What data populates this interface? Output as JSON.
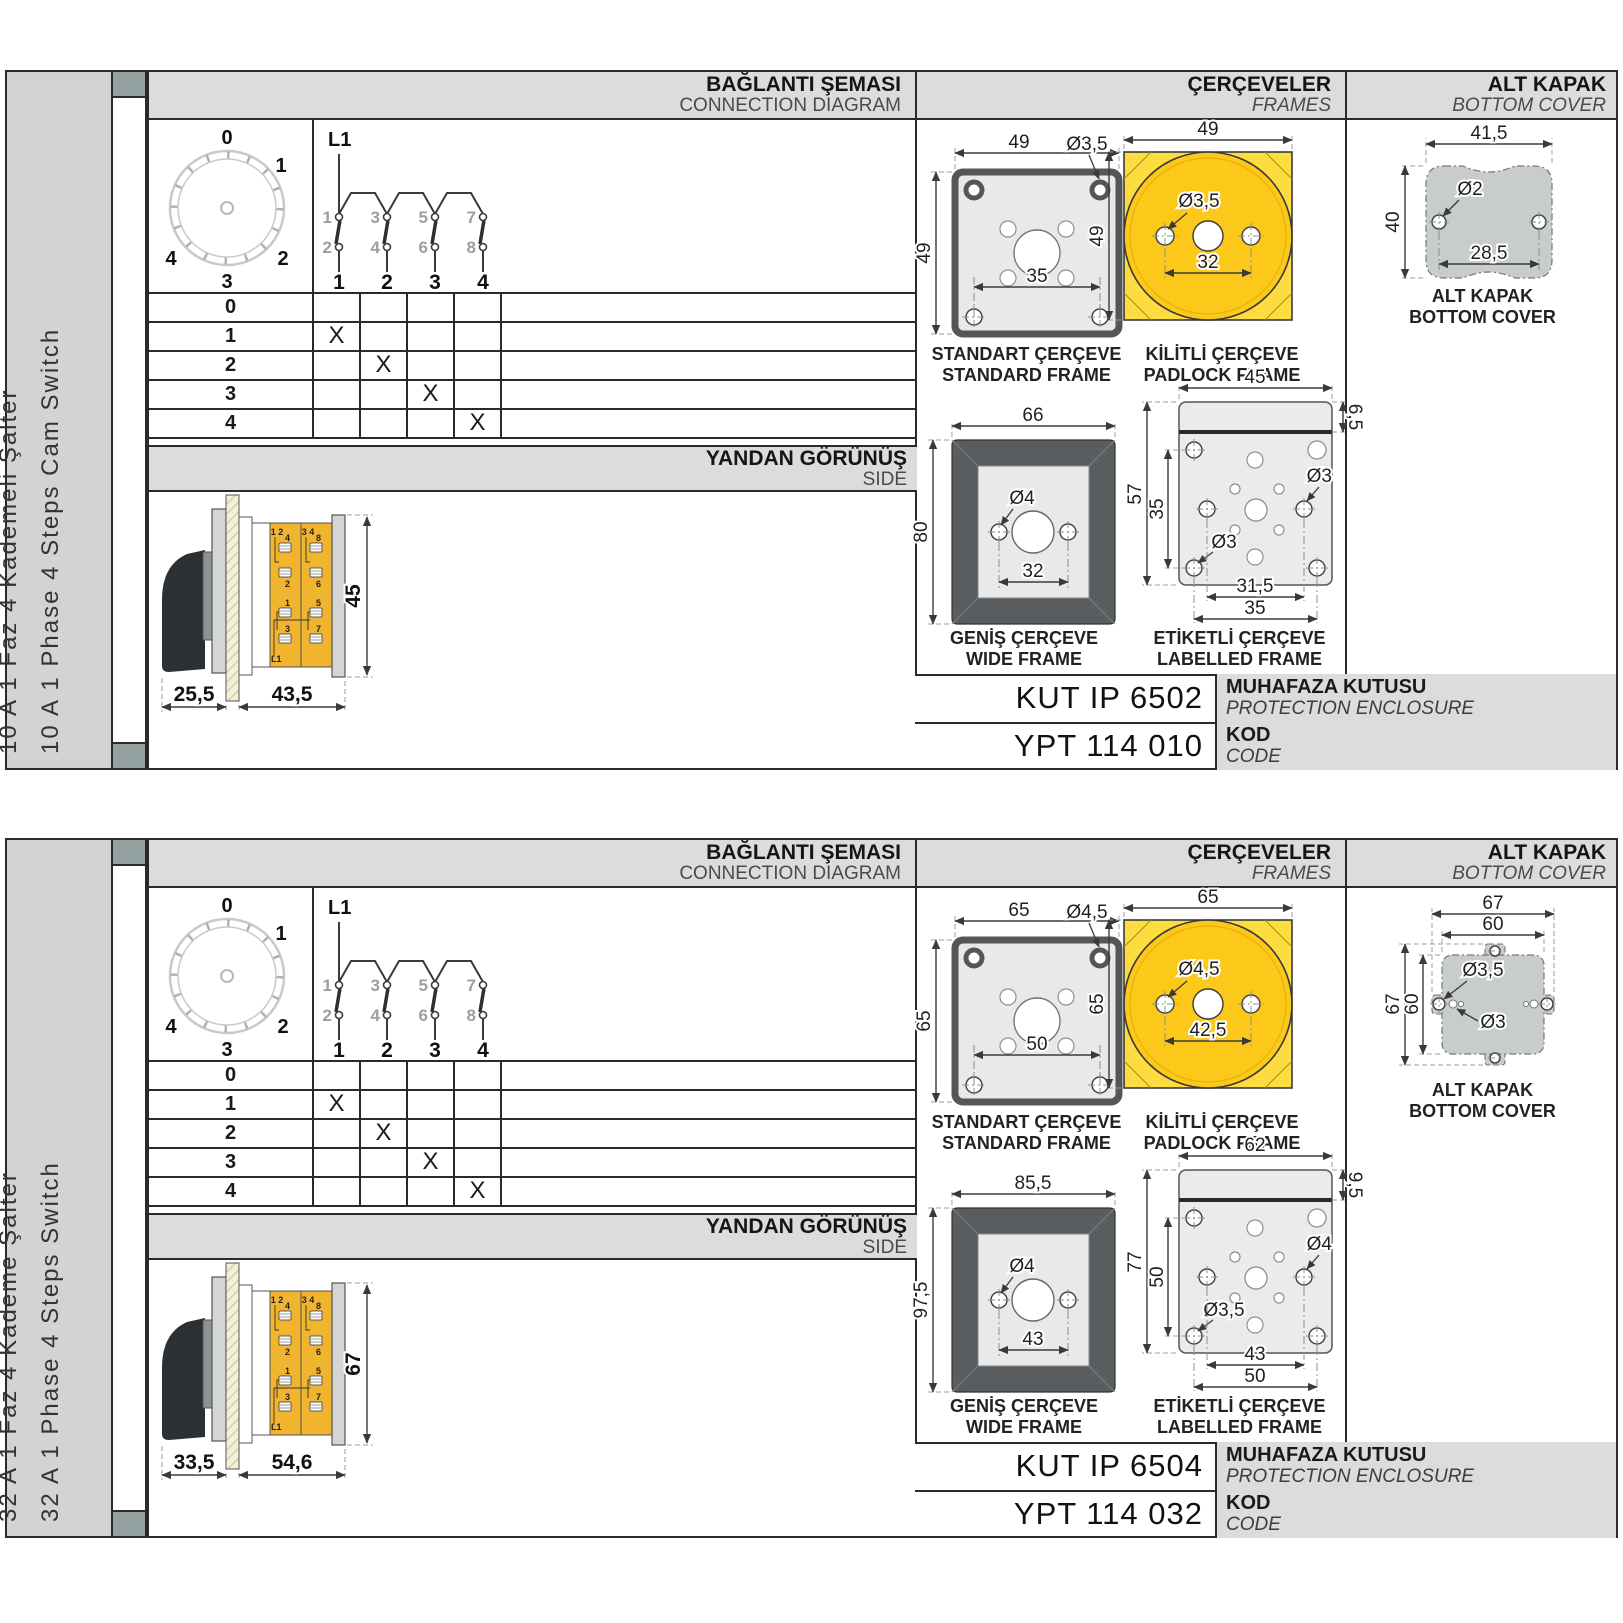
{
  "colors": {
    "accent_yellow": "#fcc91a",
    "terminal_orange": "#f0b42f",
    "band_gray": "#dcdcdc",
    "cover_gray": "#c9cccc",
    "frame_dark_gray": "#595d60"
  },
  "panels": [
    {
      "side_labels": [
        "10 A 1 Faz 4 Kademeli Şalter",
        "10 A 1 Phase 4 Steps Cam Switch"
      ],
      "headers": {
        "conn_tr": "BAĞLANTI ŞEMASI",
        "conn_en": "CONNECTION DIAGRAM",
        "frames_tr": "ÇERÇEVELER",
        "frames_en": "FRAMES",
        "cover_tr": "ALT KAPAK",
        "cover_en": "BOTTOM COVER",
        "side_tr": "YANDAN GÖRÜNÜŞ",
        "side_en": "SIDE"
      },
      "dial": [
        "0",
        "1",
        "2",
        "3",
        "4"
      ],
      "contact": {
        "feed": "L1",
        "upper": [
          "1",
          "3",
          "5",
          "7"
        ],
        "lower": [
          "2",
          "4",
          "6",
          "8"
        ],
        "poles": [
          "1",
          "2",
          "3",
          "4"
        ]
      },
      "table": {
        "rows": [
          {
            "label": "0",
            "cells": [
              "",
              "",
              "",
              ""
            ]
          },
          {
            "label": "1",
            "cells": [
              "X",
              "",
              "",
              ""
            ]
          },
          {
            "label": "2",
            "cells": [
              "",
              "X",
              "",
              ""
            ]
          },
          {
            "label": "3",
            "cells": [
              "",
              "",
              "X",
              ""
            ]
          },
          {
            "label": "4",
            "cells": [
              "",
              "",
              "",
              "X"
            ]
          }
        ]
      },
      "side_view": {
        "dim_front": "25,5",
        "dim_body": "43,5",
        "dim_height": "45",
        "t": {
          "c1top": "1 2",
          "c2top": "3 4",
          "a1": "4",
          "a2": "2",
          "a3": "1",
          "a4": "3",
          "b1": "8",
          "b2": "6",
          "b3": "5",
          "b4": "7",
          "feed": "L1"
        }
      },
      "frames": {
        "standard": {
          "cap1": "STANDART ÇERÇEVE",
          "cap2": "STANDARD FRAME",
          "w": "49",
          "h": "49",
          "hole": "Ø3,5",
          "inner": "35"
        },
        "padlock": {
          "cap1": "KİLİTLİ ÇERÇEVE",
          "cap2": "PADLOCK FRAME",
          "w": "49",
          "h": "49",
          "hole": "Ø3,5",
          "inner": "32"
        },
        "wide": {
          "cap1": "GENİŞ ÇERÇEVE",
          "cap2": "WIDE FRAME",
          "w": "66",
          "h": "80",
          "hole": "Ø4",
          "inner": "32"
        },
        "labelled": {
          "cap1": "ETİKETLİ ÇERÇEVE",
          "cap2": "LABELLED FRAME",
          "w": "45",
          "h_outer": "57",
          "h_inner": "35",
          "strip": "6,5",
          "hole_right": "Ø3",
          "hole_left": "Ø3",
          "b1": "31,5",
          "b2": "35"
        }
      },
      "cover": {
        "cap1": "ALT KAPAK",
        "cap2": "BOTTOM COVER",
        "w": "41,5",
        "h": "40",
        "hole": "Ø2",
        "inner": "28,5"
      },
      "codes": {
        "enclosure_value": "KUT IP 6502",
        "enclosure_tr": "MUHAFAZA KUTUSU",
        "enclosure_en": "PROTECTION ENCLOSURE",
        "code_value": "YPT 114 010",
        "code_tr": "KOD",
        "code_en": "CODE"
      }
    },
    {
      "side_labels": [
        "32 A 1 Faz 4 Kademe Şalter",
        "32 A 1 Phase 4 Steps Switch"
      ],
      "headers": {
        "conn_tr": "BAĞLANTI ŞEMASI",
        "conn_en": "CONNECTION DIAGRAM",
        "frames_tr": "ÇERÇEVELER",
        "frames_en": "FRAMES",
        "cover_tr": "ALT KAPAK",
        "cover_en": "BOTTOM COVER",
        "side_tr": "YANDAN GÖRÜNÜŞ",
        "side_en": "SIDE"
      },
      "dial": [
        "0",
        "1",
        "2",
        "3",
        "4"
      ],
      "contact": {
        "feed": "L1",
        "upper": [
          "1",
          "3",
          "5",
          "7"
        ],
        "lower": [
          "2",
          "4",
          "6",
          "8"
        ],
        "poles": [
          "1",
          "2",
          "3",
          "4"
        ]
      },
      "table": {
        "rows": [
          {
            "label": "0",
            "cells": [
              "",
              "",
              "",
              ""
            ]
          },
          {
            "label": "1",
            "cells": [
              "X",
              "",
              "",
              ""
            ]
          },
          {
            "label": "2",
            "cells": [
              "",
              "X",
              "",
              ""
            ]
          },
          {
            "label": "3",
            "cells": [
              "",
              "",
              "X",
              ""
            ]
          },
          {
            "label": "4",
            "cells": [
              "",
              "",
              "",
              "X"
            ]
          }
        ]
      },
      "side_view": {
        "dim_front": "33,5",
        "dim_body": "54,6",
        "dim_height": "67",
        "t": {
          "c1top": "1 2",
          "c2top": "3 4",
          "a1": "4",
          "a2": "2",
          "a3": "1",
          "a4": "3",
          "b1": "8",
          "b2": "6",
          "b3": "5",
          "b4": "7",
          "feed": "L1"
        }
      },
      "frames": {
        "standard": {
          "cap1": "STANDART ÇERÇEVE",
          "cap2": "STANDARD FRAME",
          "w": "65",
          "h": "65",
          "hole": "Ø4,5",
          "inner": "50"
        },
        "padlock": {
          "cap1": "KİLİTLİ ÇERÇEVE",
          "cap2": "PADLOCK FRAME",
          "w": "65",
          "h": "65",
          "hole": "Ø4,5",
          "inner": "42,5"
        },
        "wide": {
          "cap1": "GENİŞ ÇERÇEVE",
          "cap2": "WIDE FRAME",
          "w": "85,5",
          "h": "97,5",
          "hole": "Ø4",
          "inner": "43"
        },
        "labelled": {
          "cap1": "ETİKETLİ ÇERÇEVE",
          "cap2": "LABELLED FRAME",
          "w": "62",
          "h_outer": "77",
          "h_inner": "50",
          "strip": "9,5",
          "hole_right": "Ø4",
          "hole_left": "Ø3,5",
          "b1": "43",
          "b2": "50"
        }
      },
      "cover": {
        "cap1": "ALT KAPAK",
        "cap2": "BOTTOM COVER",
        "w1": "67",
        "w2": "60",
        "h1": "67",
        "h2": "60",
        "hole1": "Ø3,5",
        "hole2": "Ø3"
      },
      "codes": {
        "enclosure_value": "KUT IP 6504",
        "enclosure_tr": "MUHAFAZA KUTUSU",
        "enclosure_en": "PROTECTION ENCLOSURE",
        "code_value": "YPT 114 032",
        "code_tr": "KOD",
        "code_en": "CODE"
      }
    }
  ]
}
